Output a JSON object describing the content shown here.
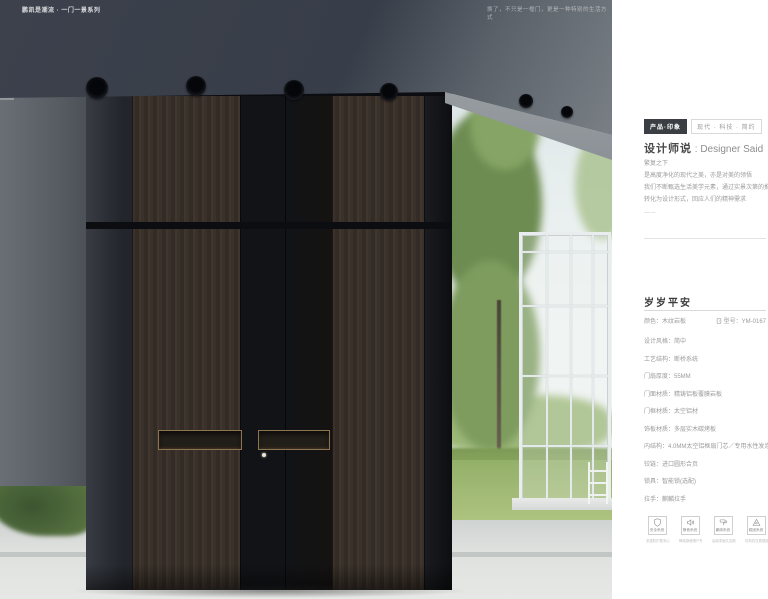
{
  "photo": {
    "top_left_label": "鹏凯是潮流 · 一门一景系列",
    "top_right_label": "换了，不只是一樘门，更是一种特别的生活方式"
  },
  "panel": {
    "tags": {
      "primary": "产品·印象",
      "secondary": "现代 · 科技 · 简约"
    },
    "designer": {
      "title_zh": "设计师说",
      "title_en": " : Designer Said",
      "lines": [
        "繁复之下",
        "是高度净化的现代之美，亦是对美的领悟",
        "我们不断甄选生活美学元素，通过实景次第的推演与文化淬炼",
        "转化为设计形式，回应人们的精神需求",
        "……"
      ]
    },
    "product": {
      "name": "岁岁平安",
      "color_label": "颜色：木纹岩板",
      "model_label": "型号：YM-0167"
    },
    "specs": [
      "设计风格：简中",
      "工艺结构：断桥系统",
      "门扇厚度：55MM",
      "门面材质：精铸铝板覆膜岩板",
      "门框材质：太空铝材",
      "饰板材质：多层实木碳烤板",
      "内结构：4.0MM太空铝框扇门芯／专用水性发泡板",
      "铰链：进口圆形合页",
      "锁具：智能锁(选配)",
      "拉手：麒麟拉手"
    ],
    "features": [
      {
        "label": "安全系统",
        "caption": "多重防护更安心"
      },
      {
        "label": "静音系统",
        "caption": "降噪静音隔户外"
      },
      {
        "label": "氟碳系统",
        "caption": "氟碳漆面久如新"
      },
      {
        "label": "稳固系统",
        "caption": "抗风抗压更稳固"
      }
    ]
  },
  "colors": {
    "tag_dark": "#3b3e43",
    "bronze": "#8a6e4c",
    "wood": "#3a312a",
    "canopy": "#3c414c",
    "grass": "#93b069"
  }
}
